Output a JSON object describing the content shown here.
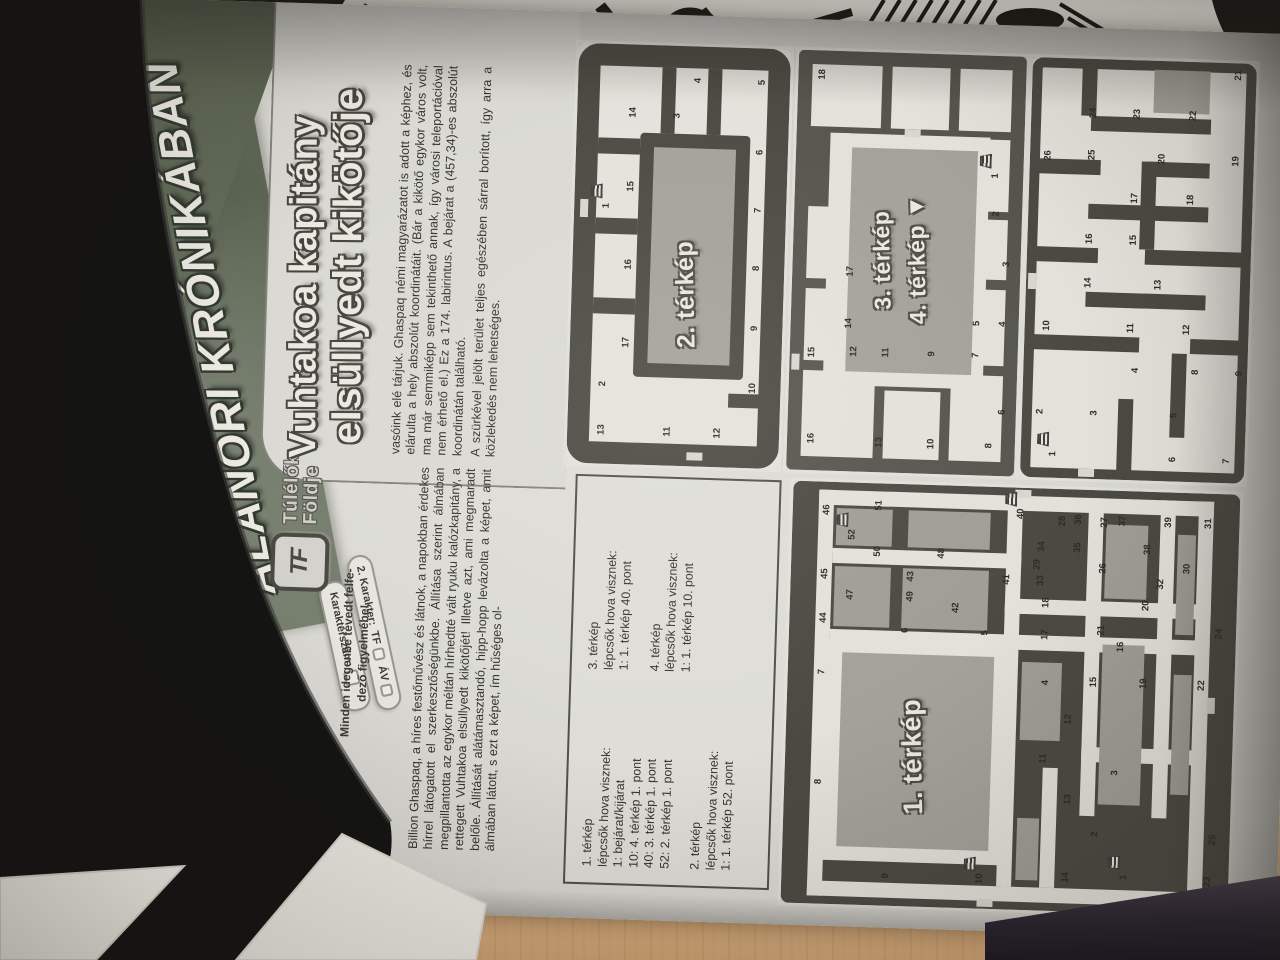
{
  "scene": {
    "handwritten_mark": "5."
  },
  "banner": {
    "line1": "KUPONOK AZ",
    "line2": "ALANORI KRÓNIKÁBAN"
  },
  "coupons": {
    "tf_label": "TF",
    "av_label": "ÁV",
    "serial_label": "Karakterszám:",
    "items": [
      {
        "label": "1. Karakter:"
      },
      {
        "label": "2. Karakter:"
      },
      {
        "label": "3. Karakter:"
      }
    ]
  },
  "logo": {
    "monogram": "TF",
    "name_line1": "Túlélők",
    "name_line2": "Földje"
  },
  "slogan": {
    "line1": "Minden idegenbe tévedt felfe-",
    "line2": "dező figyelmébe!"
  },
  "heading": {
    "line1": "Vuhtakoa kapitány",
    "line2": "elsüllyedt kikötője"
  },
  "article": {
    "col1": "Billion Ghaspaq, a híres festőművész és látnok, a napokban érdekes hírrel látogatott el szerkesztőségünkbe. Állítása szerint álmában megpillantotta az egykor méltán hírhedtté vált ryuku kalózkapitány, a rettegett Vuhtakoa elsüllyedt kikötőjét! Illetve azt, ami megmaradt belőle. Állítását alátámasztandó, hipp-hopp levázolta a képet, amit álmában látott, s ezt a képet, ím hűséges ol-",
    "col2_p1": "vasóink elé tárjuk. Ghaspaq némi magyarázatot is adott a képhez, és elárulta a hely abszolút koordinátáit. (Bár a kikötő egykor város volt, ma már semmiképp sem tekinthető annak, így városi teleportációval nem érhető el.) Ez a 174. labirintus. A bejárat a (457,34)-es abszolút koordinátán található.",
    "col2_p2": "A szürkével jelölt terület teljes egészében sárral borított, így arra a közlekedés nem lehetséges."
  },
  "legend": {
    "col1": [
      "1. térkép",
      "lépcsők hova visznek:",
      "1: bejárat/kijárat",
      "10: 4. térkép 1. pont",
      "40: 3. térkép 1. pont",
      "52: 2. térkép 1. pont",
      "",
      "2. térkép",
      "lépcsők hova visznek:",
      "1: 1. térkép 52. pont"
    ],
    "col2": [
      "3. térkép",
      "lépcsők hova visznek:",
      "1: 1. térkép 40. pont",
      "",
      "4. térkép",
      "lépcsők hova visznek:",
      "1: 1. térkép 10. pont"
    ]
  },
  "maps": {
    "map1": {
      "label": "1. térkép",
      "numbers": [
        [
          1,
          36,
          342,
          1
        ],
        [
          2,
          78,
          312
        ],
        [
          3,
          140,
          330
        ],
        [
          4,
          228,
          258
        ],
        [
          5,
          276,
          196
        ],
        [
          6,
          276,
          116
        ],
        [
          7,
          232,
          34
        ],
        [
          8,
          122,
          34
        ],
        [
          9,
          30,
          104
        ],
        [
          10,
          30,
          198,
          1
        ],
        [
          11,
          152,
          258
        ],
        [
          12,
          192,
          282
        ],
        [
          13,
          112,
          284
        ],
        [
          14,
          34,
          284
        ],
        [
          15,
          230,
          306
        ],
        [
          16,
          266,
          332
        ],
        [
          17,
          276,
          256
        ],
        [
          18,
          308,
          256
        ],
        [
          19,
          230,
          356
        ],
        [
          20,
          308,
          356
        ],
        [
          21,
          282,
          312
        ],
        [
          22,
          230,
          414
        ],
        [
          23,
          34,
          426
        ],
        [
          24,
          282,
          430
        ],
        [
          25,
          76,
          430
        ],
        [
          26,
          344,
          312
        ],
        [
          27,
          390,
          312
        ],
        [
          28,
          390,
          270
        ],
        [
          29,
          346,
          246
        ],
        [
          30,
          346,
          396
        ],
        [
          31,
          392,
          416
        ],
        [
          32,
          330,
          370
        ],
        [
          33,
          330,
          250
        ],
        [
          34,
          364,
          250
        ],
        [
          35,
          364,
          286
        ],
        [
          36,
          392,
          286
        ],
        [
          37,
          392,
          330
        ],
        [
          38,
          364,
          356
        ],
        [
          39,
          392,
          376
        ],
        [
          40,
          396,
          228,
          1
        ],
        [
          41,
          330,
          216
        ],
        [
          42,
          300,
          166
        ],
        [
          43,
          330,
          120
        ],
        [
          44,
          286,
          34
        ],
        [
          45,
          330,
          34
        ],
        [
          46,
          394,
          34
        ],
        [
          47,
          310,
          60
        ],
        [
          48,
          354,
          150
        ],
        [
          49,
          310,
          120
        ],
        [
          50,
          354,
          86
        ],
        [
          51,
          400,
          86
        ],
        [
          52,
          370,
          60,
          1
        ]
      ]
    },
    "map2": {
      "label": "2. térkép",
      "numbers": [
        [
          13,
          34,
          34
        ],
        [
          2,
          80,
          34
        ],
        [
          1,
          258,
          32,
          1
        ],
        [
          17,
          122,
          56
        ],
        [
          16,
          200,
          56
        ],
        [
          15,
          278,
          56
        ],
        [
          14,
          352,
          56
        ],
        [
          11,
          34,
          100
        ],
        [
          12,
          34,
          150
        ],
        [
          10,
          80,
          184
        ],
        [
          9,
          140,
          184
        ],
        [
          8,
          200,
          184
        ],
        [
          7,
          258,
          184
        ],
        [
          6,
          316,
          184
        ],
        [
          5,
          386,
          184
        ],
        [
          4,
          386,
          120
        ],
        [
          3,
          350,
          100
        ]
      ]
    },
    "map3": {
      "label": "3. térkép",
      "label2": "4. térkép",
      "arrow": "▼",
      "numbers": [
        [
          1,
          300,
          200,
          1
        ],
        [
          2,
          262,
          202
        ],
        [
          3,
          212,
          214
        ],
        [
          4,
          152,
          212
        ],
        [
          5,
          152,
          186
        ],
        [
          6,
          64,
          214
        ],
        [
          7,
          120,
          186
        ],
        [
          8,
          30,
          202
        ],
        [
          9,
          120,
          142
        ],
        [
          10,
          30,
          144
        ],
        [
          11,
          120,
          96
        ],
        [
          12,
          120,
          64
        ],
        [
          13,
          30,
          92
        ],
        [
          14,
          148,
          58
        ],
        [
          15,
          118,
          22
        ],
        [
          16,
          32,
          24
        ],
        [
          17,
          200,
          58
        ],
        [
          18,
          396,
          24
        ]
      ]
    },
    "map4": {
      "numbers": [
        [
          1,
          24,
          32,
          1
        ],
        [
          2,
          66,
          18
        ],
        [
          3,
          66,
          72
        ],
        [
          4,
          110,
          112
        ],
        [
          5,
          66,
          152
        ],
        [
          6,
          22,
          152
        ],
        [
          7,
          22,
          206
        ],
        [
          8,
          110,
          172
        ],
        [
          9,
          110,
          216
        ],
        [
          10,
          152,
          22
        ],
        [
          11,
          152,
          106
        ],
        [
          12,
          152,
          162
        ],
        [
          13,
          196,
          132
        ],
        [
          14,
          196,
          62
        ],
        [
          15,
          240,
          106
        ],
        [
          16,
          240,
          62
        ],
        [
          17,
          282,
          106
        ],
        [
          18,
          282,
          162
        ],
        [
          19,
          322,
          206
        ],
        [
          20,
          322,
          132
        ],
        [
          21,
          408,
          206
        ],
        [
          22,
          366,
          162
        ],
        [
          23,
          366,
          106
        ],
        [
          24,
          366,
          62
        ],
        [
          25,
          324,
          62
        ],
        [
          26,
          322,
          18
        ]
      ]
    }
  }
}
